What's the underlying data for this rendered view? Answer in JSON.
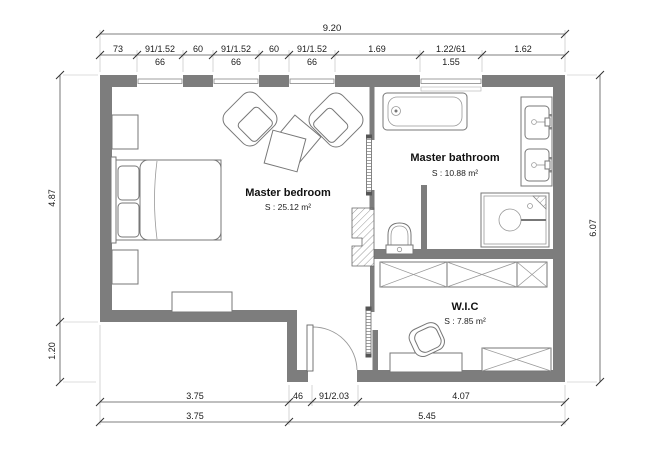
{
  "rooms": [
    {
      "name": "Master bedroom",
      "area": "S : 25.12 m²"
    },
    {
      "name": "Master bathroom",
      "area": "S : 10.88 m²"
    },
    {
      "name": "W.I.C",
      "area": "S : 7.85 m²"
    }
  ],
  "dimensions": {
    "top_total": "9.20",
    "top_segments": [
      "73",
      "91/1.52",
      "60",
      "91/1.52",
      "60",
      "91/1.52",
      "1.69",
      "1.22/61",
      "1.62"
    ],
    "top_sublabels": [
      "66",
      "66",
      "66",
      "1.55"
    ],
    "bottom_row1": [
      "3.75",
      "46",
      "91/2.03",
      "4.07"
    ],
    "bottom_row2": [
      "3.75",
      "5.45"
    ],
    "left": [
      "4.87",
      "1.20"
    ],
    "right": [
      "6.07"
    ]
  },
  "colors": {
    "wall": "#7d7d7d",
    "furniture_line": "#777777",
    "dimension_line": "#555555",
    "text": "#1a1a1a",
    "background": "#ffffff"
  }
}
